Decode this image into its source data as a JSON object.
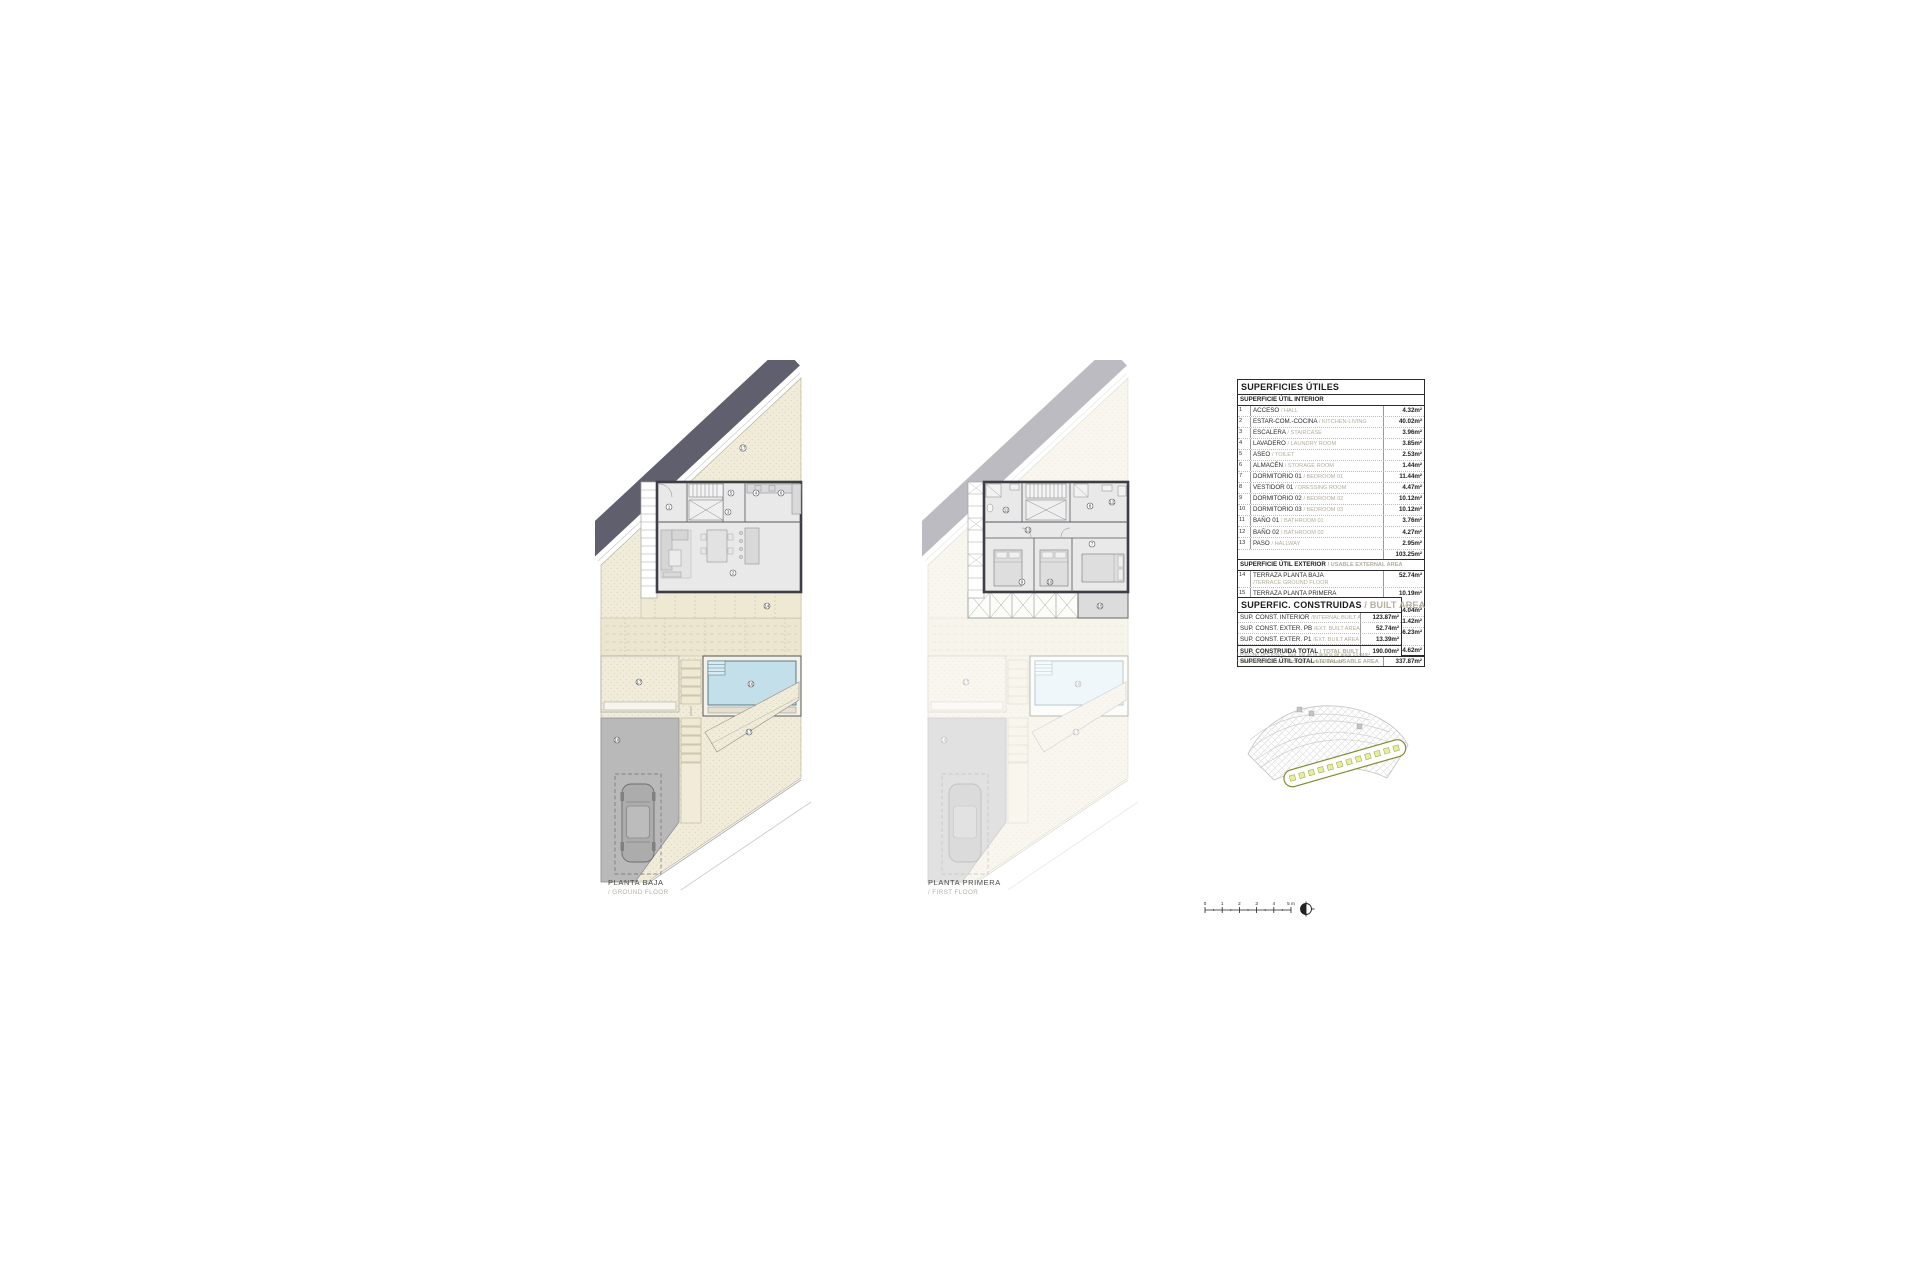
{
  "sheet": {
    "background": "#ffffff"
  },
  "plans": {
    "ground": {
      "label": "PLANTA BAJA",
      "sublabel": "/ GROUND FLOOR",
      "markers": [
        "17",
        "5",
        "4",
        "6",
        "1",
        "3",
        "2",
        "14",
        "17",
        "16",
        "18",
        "17"
      ]
    },
    "first": {
      "label": "PLANTA PRIMERA",
      "sublabel": "/ FIRST FLOOR",
      "markers": [
        "11",
        "8",
        "12",
        "13",
        "7",
        "9",
        "10",
        "15",
        "17",
        "16",
        "18",
        "17"
      ]
    }
  },
  "tables": {
    "useful": {
      "title": "SUPERFICIES ÚTILES",
      "interior_header": "SUPERFICIE ÚTIL INTERIOR",
      "interior_rows": [
        {
          "num": "1",
          "es": "ACCESO",
          "en": "/ HALL",
          "value": "4.32m²"
        },
        {
          "num": "2",
          "es": "ESTAR-COM.-COCINA",
          "en": "/ KITCHEN-LIVING",
          "value": "40.02m²"
        },
        {
          "num": "3",
          "es": "ESCALERA",
          "en": "/ STAIRCASE",
          "value": "3.96m²"
        },
        {
          "num": "4",
          "es": "LAVADERO",
          "en": "/ LAUNDRY ROOM",
          "value": "3.85m²"
        },
        {
          "num": "5",
          "es": "ASEO",
          "en": "/ TOILET",
          "value": "2.53m²"
        },
        {
          "num": "6",
          "es": "ALMACÉN",
          "en": "/ STORAGE ROOM",
          "value": "1.44m²"
        },
        {
          "num": "7",
          "es": "DORMITORIO 01",
          "en": "/ BEDROOM 01",
          "value": "11.44m²"
        },
        {
          "num": "8",
          "es": "VESTIDOR 01",
          "en": "/ DRESSING ROOM",
          "value": "4.47m²"
        },
        {
          "num": "9",
          "es": "DORMITORIO 02",
          "en": "/ BEDROOM 02",
          "value": "10.12m²"
        },
        {
          "num": "10",
          "es": "DORMITORIO 03",
          "en": "/ BEDROOM 03",
          "value": "10.12m²"
        },
        {
          "num": "11",
          "es": "BAÑO 01",
          "en": "/ BATHROOM 01",
          "value": "3.76m²"
        },
        {
          "num": "12",
          "es": "BAÑO 02",
          "en": "/ BATHROOM 02",
          "value": "4.27m²"
        },
        {
          "num": "13",
          "es": "PASO",
          "en": "/ HALLWAY",
          "value": "2.95m²"
        }
      ],
      "interior_subtotal": "103.25m²",
      "exterior_header_es": "SUPERFICIE ÚTIL EXTERIOR",
      "exterior_header_en": "/ USABLE EXTERNAL AREA",
      "exterior_rows": [
        {
          "num": "14",
          "es": "TERRAZA PLANTA BAJA",
          "en": "/TERRACE GROUND FLOOR",
          "value": "52.74m²"
        },
        {
          "num": "15",
          "es": "TERRAZA PLANTA PRIMERA",
          "en": "/TERRACE FIRST FLOOR",
          "value": "10.19m²"
        },
        {
          "num": "16",
          "es": "PISCINA",
          "en": "/SWIMMING POOL",
          "value": "14.04m²"
        },
        {
          "num": "17",
          "es": "JARDÍN",
          "en": "/GARDEN",
          "value": "111.42m²"
        },
        {
          "num": "18",
          "es": "ESPACIO APARCAMIENTO",
          "en": "/PARKING SPACE",
          "value": "46.23m²"
        }
      ],
      "exterior_subtotal": "234.62m²",
      "total_es": "SUPERFICIE ÚTIL TOTAL",
      "total_en": "/ TOTAL USABLE AREA",
      "total_value": "337.87m²"
    },
    "built": {
      "title_es": "SUPERFIC. CONSTRUIDAS",
      "title_en": "/ BUILT AREA",
      "rows": [
        {
          "es": "SUP. CONST. INTERIOR",
          "en": "/INTERNAL BUILT AREA",
          "value": "123.87m²"
        },
        {
          "es": "SUP. CONST. EXTER. PB",
          "en": "/EXT. BUILT AREA PB",
          "value": "52.74m²"
        },
        {
          "es": "SUP. CONST. EXTER. P1",
          "en": "/EXT. BUILT AREA P1",
          "value": "13.39m²"
        },
        {
          "es": "SUP. CONSTRUIDA TOTAL",
          "en": "/ TOTAL BUILT AREA",
          "value": "190.00m²"
        }
      ],
      "footnote_1": "* PISCINA OPCIONAL: Sup. útil de la lámina de agua 14.04m²",
      "footnote_2": "* SWIMMING POOL OPTIONAL: Surface 14.04m²"
    }
  },
  "scalebar": {
    "ticks": [
      "0",
      "1",
      "2",
      "3",
      "4",
      "5 m"
    ]
  },
  "colors": {
    "garden_beige": "#f0ecd9",
    "road_band_dark": "#5f5f6d",
    "pool_water": "#c3dfe9",
    "driveway_gray": "#b9b9b9",
    "wall_dark": "#3d3d45",
    "floor_gray": "#e9e9e9",
    "site_accent_olive": "#7d8c34",
    "plot_square_fill": "#e7ec9e",
    "table_secondary_text": "#b2ae9b"
  }
}
